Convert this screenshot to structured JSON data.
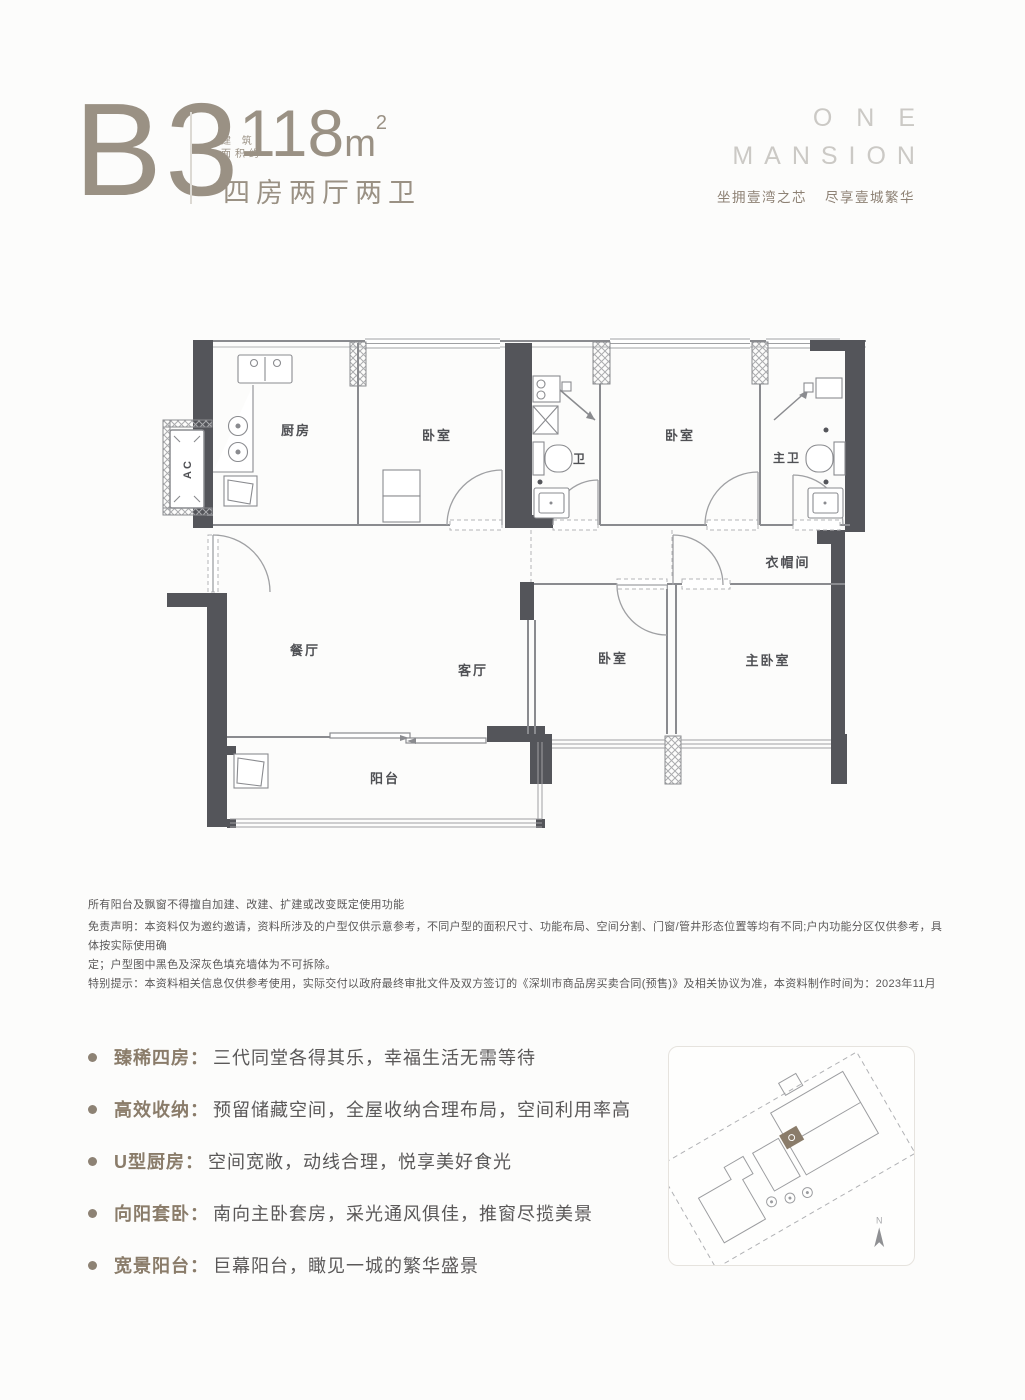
{
  "header": {
    "unit_code": "B3",
    "area_label_line1": "建 筑",
    "area_label_line2": "面积约",
    "area_value": "118",
    "area_unit": "m",
    "area_exponent": "2",
    "layout_text": "四房两厅两卫"
  },
  "brand": {
    "name_line1": "ONE",
    "name_line2": "MANSION",
    "tagline_left": "坐拥壹湾之芯",
    "tagline_right": "尽享壹城繁华"
  },
  "floorplan": {
    "rooms": [
      {
        "id": "kitchen",
        "label": "厨房"
      },
      {
        "id": "bedroom-1",
        "label": "卧室"
      },
      {
        "id": "bathroom",
        "label": "卫"
      },
      {
        "id": "bedroom-2",
        "label": "卧室"
      },
      {
        "id": "master-bathroom",
        "label": "主卫"
      },
      {
        "id": "cloakroom",
        "label": "衣帽间"
      },
      {
        "id": "dining-room",
        "label": "餐厅"
      },
      {
        "id": "living-room",
        "label": "客厅"
      },
      {
        "id": "bedroom-3",
        "label": "卧室"
      },
      {
        "id": "master-bedroom",
        "label": "主卧室"
      },
      {
        "id": "balcony",
        "label": "阳台"
      },
      {
        "id": "ac-unit",
        "label": "AC"
      }
    ]
  },
  "disclaimer": {
    "lines": [
      "所有阳台及飘窗不得擅自加建、改建、扩建或改变既定使用功能",
      "免责声明：本资料仅为邀约邀请，资料所涉及的户型仅供示意参考，不同户型的面积尺寸、功能布局、空间分割、门窗/管井形态位置等均有不同;户内功能分区仅供参考，具体按实际使用确",
      "定；户型图中黑色及深灰色填充墙体为不可拆除。",
      "特别提示：本资料相关信息仅供参考使用，实际交付以政府最终审批文件及双方签订的《深圳市商品房买卖合同(预售)》及相关协议为准，本资料制作时间为：2023年11月"
    ]
  },
  "features": [
    {
      "label": "臻稀四房：",
      "text": "三代同堂各得其乐，幸福生活无需等待"
    },
    {
      "label": "高效收纳：",
      "text": "预留储藏空间，全屋收纳合理布局，空间利用率高"
    },
    {
      "label": "U型厨房：",
      "text": "空间宽敞，动线合理，悦享美好食光"
    },
    {
      "label": "向阳套卧：",
      "text": "南向主卧套房，采光通风俱佳，推窗尽揽美景"
    },
    {
      "label": "宽景阳台：",
      "text": "巨幕阳台，瞰见一城的繁华盛景"
    }
  ],
  "siteplan": {
    "north_label": "N"
  },
  "colors": {
    "accent_tan": "#9a9184",
    "brand_gray": "#cbc9c5",
    "tagline_brown": "#8d8174",
    "wall_dark": "#54555a",
    "text_dark": "#5a5858",
    "feature_label_brown": "#8a7c6a"
  }
}
